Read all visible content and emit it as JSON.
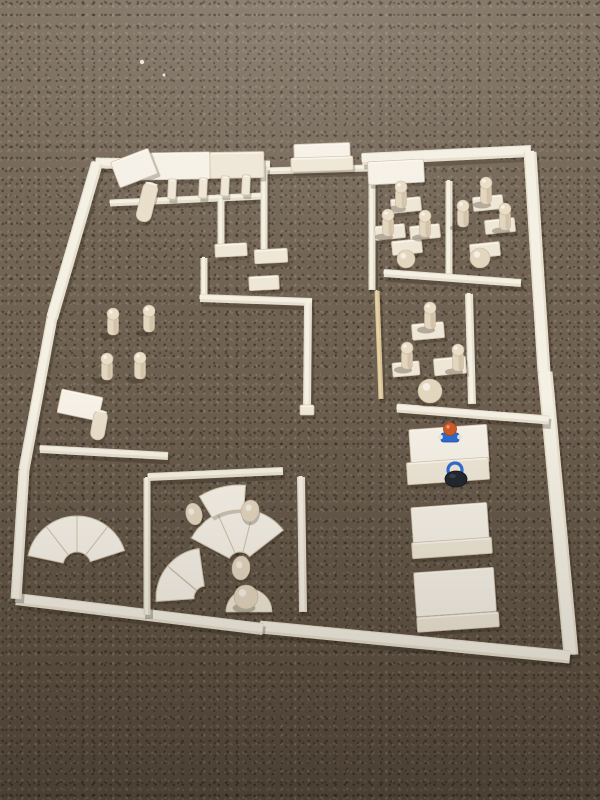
{
  "scene": {
    "description": "Photograph of a building floor plan constructed from light wooden unit blocks on brown carpet, with wooden peg dolls, desks, fan-shaped quarter-circle blocks, stacked board platforms and two small colored toy figures.",
    "colors": {
      "wall_base": "#e7dfcd",
      "wall_core": "#f5f0e4",
      "block_base": "#eee6d6",
      "block_bright": "#f6f1e7",
      "block_stroke": "#d0c3ab",
      "block_highlight": "#fbf7ef",
      "cylinder": "#e9deca",
      "tan_base": "#d9c396",
      "tan_core": "#e6d3a8",
      "peg_body": "#e3d6bf",
      "peg_shade": "#bdab8e",
      "peg_head": "#e9ddc7",
      "peg_stroke": "#c6b498",
      "shadow": "#2a2014",
      "figure_orange": "#cf5a2a",
      "figure_blue": "#2f6bd0",
      "figure_dark": "#23272f",
      "speck_white": "#f4f1ea"
    },
    "walls": [
      {
        "name": "top-wall-left",
        "x1": 96,
        "y1": 163,
        "x2": 270,
        "y2": 166,
        "w": 11
      },
      {
        "name": "top-door-rail",
        "x1": 264,
        "y1": 171,
        "x2": 368,
        "y2": 168,
        "w": 7
      },
      {
        "name": "top-wall-right",
        "x1": 362,
        "y1": 159,
        "x2": 531,
        "y2": 151,
        "w": 12
      },
      {
        "name": "right-wall-upper",
        "x1": 530,
        "y1": 152,
        "x2": 544,
        "y2": 372,
        "w": 13
      },
      {
        "name": "right-wall-lower",
        "x1": 545,
        "y1": 372,
        "x2": 571,
        "y2": 655,
        "w": 15
      },
      {
        "name": "bottom-wall-right",
        "x1": 260,
        "y1": 627,
        "x2": 570,
        "y2": 657,
        "w": 13
      },
      {
        "name": "bottom-wall-left",
        "x1": 16,
        "y1": 599,
        "x2": 263,
        "y2": 629,
        "w": 12
      },
      {
        "name": "left-wall-upper",
        "x1": 97,
        "y1": 163,
        "x2": 52,
        "y2": 318,
        "w": 12
      },
      {
        "name": "left-wall-middle",
        "x1": 52,
        "y1": 318,
        "x2": 24,
        "y2": 470,
        "w": 11
      },
      {
        "name": "left-wall-lower",
        "x1": 24,
        "y1": 470,
        "x2": 16,
        "y2": 599,
        "w": 11
      },
      {
        "name": "colonnade-rail",
        "x1": 110,
        "y1": 203,
        "x2": 262,
        "y2": 196,
        "w": 7
      },
      {
        "name": "maze-wall-vertical-1",
        "x1": 264,
        "y1": 166,
        "x2": 264,
        "y2": 257,
        "w": 7
      },
      {
        "name": "maze-wall-vertical-2",
        "x1": 221,
        "y1": 200,
        "x2": 221,
        "y2": 246,
        "w": 7
      },
      {
        "name": "maze-wall-vertical-3",
        "x1": 204,
        "y1": 258,
        "x2": 204,
        "y2": 297,
        "w": 7
      },
      {
        "name": "maze-wall-horizontal",
        "x1": 200,
        "y1": 298,
        "x2": 312,
        "y2": 302,
        "w": 8
      },
      {
        "name": "corridor-wall",
        "x1": 308,
        "y1": 303,
        "x2": 307,
        "y2": 410,
        "w": 8
      },
      {
        "name": "classroom1-left-wall",
        "x1": 372,
        "y1": 182,
        "x2": 372,
        "y2": 290,
        "w": 7
      },
      {
        "name": "classroom1-divider",
        "x1": 449,
        "y1": 181,
        "x2": 449,
        "y2": 274,
        "w": 7
      },
      {
        "name": "classroom1-bottom-wall",
        "x1": 384,
        "y1": 273,
        "x2": 521,
        "y2": 283,
        "w": 8
      },
      {
        "name": "classroom2-left-stick",
        "x1": 377,
        "y1": 291,
        "x2": 381,
        "y2": 399,
        "w": 5,
        "tone": "tan"
      },
      {
        "name": "classroom2-divider",
        "x1": 469,
        "y1": 294,
        "x2": 472,
        "y2": 404,
        "w": 8
      },
      {
        "name": "classroom2-bottom-wall",
        "x1": 397,
        "y1": 408,
        "x2": 549,
        "y2": 420,
        "w": 9
      },
      {
        "name": "left-room-wall",
        "x1": 40,
        "y1": 449,
        "x2": 168,
        "y2": 456,
        "w": 8
      },
      {
        "name": "playroom-top-wall",
        "x1": 148,
        "y1": 477,
        "x2": 283,
        "y2": 471,
        "w": 8
      },
      {
        "name": "playroom-left-wall",
        "x1": 147,
        "y1": 478,
        "x2": 147,
        "y2": 615,
        "w": 7
      },
      {
        "name": "playroom-right-wall",
        "x1": 301,
        "y1": 477,
        "x2": 303,
        "y2": 612,
        "w": 8
      }
    ],
    "blocks": [
      {
        "name": "roof-board-1",
        "cx": 172,
        "cy": 166,
        "w": 76,
        "h": 27,
        "rot": -1,
        "tone": "bright"
      },
      {
        "name": "roof-board-2",
        "cx": 237,
        "cy": 165,
        "w": 54,
        "h": 26,
        "rot": -1
      },
      {
        "name": "tower-block",
        "cx": 134,
        "cy": 168,
        "w": 40,
        "h": 27,
        "rot": -21,
        "tone": "bright"
      },
      {
        "name": "tower-cylinder",
        "cx": 147,
        "cy": 202,
        "w": 15,
        "h": 40,
        "rot": 14,
        "tone": "cyl",
        "rx": 7
      },
      {
        "name": "colonnade-pillar-1",
        "cx": 172,
        "cy": 189,
        "w": 8,
        "h": 20,
        "rot": 3
      },
      {
        "name": "colonnade-pillar-2",
        "cx": 203,
        "cy": 188,
        "w": 8,
        "h": 20,
        "rot": 3
      },
      {
        "name": "colonnade-pillar-3",
        "cx": 225,
        "cy": 186,
        "w": 8,
        "h": 20,
        "rot": 3
      },
      {
        "name": "colonnade-pillar-4",
        "cx": 246,
        "cy": 185,
        "w": 8,
        "h": 20,
        "rot": 3
      },
      {
        "name": "entrance-block-top",
        "cx": 322,
        "cy": 151,
        "w": 56,
        "h": 15,
        "rot": -2,
        "tone": "bright"
      },
      {
        "name": "entrance-block-base",
        "cx": 322,
        "cy": 164,
        "w": 62,
        "h": 14,
        "rot": -2
      },
      {
        "name": "classroom1-header-block",
        "cx": 396,
        "cy": 172,
        "w": 56,
        "h": 23,
        "rot": -3,
        "tone": "bright"
      },
      {
        "name": "maze-block-1",
        "cx": 231,
        "cy": 250,
        "w": 32,
        "h": 13,
        "rot": -3
      },
      {
        "name": "maze-block-2",
        "cx": 271,
        "cy": 256,
        "w": 33,
        "h": 14,
        "rot": -3
      },
      {
        "name": "maze-block-3",
        "cx": 264,
        "cy": 283,
        "w": 30,
        "h": 14,
        "rot": -3
      },
      {
        "name": "corridor-foot-block",
        "cx": 307,
        "cy": 410,
        "w": 14,
        "h": 10,
        "rot": 0
      },
      {
        "name": "classroom1-desk-1",
        "cx": 406,
        "cy": 205,
        "w": 30,
        "h": 14,
        "rot": -6
      },
      {
        "name": "classroom1-desk-2",
        "cx": 390,
        "cy": 232,
        "w": 30,
        "h": 14,
        "rot": -6
      },
      {
        "name": "classroom1-desk-3",
        "cx": 425,
        "cy": 232,
        "w": 30,
        "h": 14,
        "rot": -6
      },
      {
        "name": "classroom1-desk-4",
        "cx": 407,
        "cy": 247,
        "w": 30,
        "h": 14,
        "rot": -6
      },
      {
        "name": "classroom1-desk-5",
        "cx": 488,
        "cy": 203,
        "w": 30,
        "h": 14,
        "rot": -6
      },
      {
        "name": "classroom1-desk-6",
        "cx": 500,
        "cy": 226,
        "w": 30,
        "h": 14,
        "rot": -6
      },
      {
        "name": "classroom1-desk-7",
        "cx": 485,
        "cy": 250,
        "w": 30,
        "h": 14,
        "rot": -6
      },
      {
        "name": "classroom2-desk-1",
        "cx": 428,
        "cy": 331,
        "w": 32,
        "h": 16,
        "rot": -5
      },
      {
        "name": "classroom2-desk-2",
        "cx": 406,
        "cy": 369,
        "w": 27,
        "h": 14,
        "rot": -5
      },
      {
        "name": "classroom2-desk-3",
        "cx": 450,
        "cy": 366,
        "w": 32,
        "h": 17,
        "rot": -5
      },
      {
        "name": "table-block",
        "cx": 80,
        "cy": 405,
        "w": 42,
        "h": 24,
        "rot": 12,
        "tone": "bright"
      },
      {
        "name": "table-cylinder",
        "cx": 99,
        "cy": 425,
        "w": 14,
        "h": 30,
        "rot": 10,
        "tone": "cyl",
        "rx": 7
      },
      {
        "name": "platform1-board",
        "cx": 449,
        "cy": 446,
        "w": 78,
        "h": 38,
        "rot": -4,
        "tone": "bright"
      },
      {
        "name": "platform1-base",
        "cx": 448,
        "cy": 471,
        "w": 82,
        "h": 22,
        "rot": -4
      },
      {
        "name": "platform2-board",
        "cx": 450,
        "cy": 523,
        "w": 76,
        "h": 36,
        "rot": -4,
        "tone": "bright"
      },
      {
        "name": "platform2-base",
        "cx": 452,
        "cy": 548,
        "w": 80,
        "h": 16,
        "rot": -4
      },
      {
        "name": "platform3-board",
        "cx": 455,
        "cy": 592,
        "w": 80,
        "h": 44,
        "rot": -4,
        "tone": "bright"
      },
      {
        "name": "platform3-base",
        "cx": 458,
        "cy": 622,
        "w": 82,
        "h": 15,
        "rot": -4
      }
    ],
    "fans": [
      {
        "name": "fan-left",
        "cx": 77,
        "cy": 566,
        "r1": 14,
        "r2": 50,
        "segments": [
          [
            -168,
            -128
          ],
          [
            -128,
            -90
          ],
          [
            -90,
            -52
          ],
          [
            -52,
            -18
          ]
        ]
      },
      {
        "name": "fan-center-main",
        "cx": 240,
        "cy": 564,
        "r1": 12,
        "r2": 55,
        "segments": [
          [
            -152,
            -114
          ],
          [
            -114,
            -76
          ],
          [
            -76,
            -38
          ]
        ]
      },
      {
        "name": "fan-center-outer",
        "cx": 240,
        "cy": 564,
        "r1": 54,
        "r2": 79,
        "segments": [
          [
            -121,
            -86
          ]
        ]
      },
      {
        "name": "fan-lower",
        "cx": 206,
        "cy": 598,
        "r1": 12,
        "r2": 50,
        "segments": [
          [
            -184,
            -140
          ],
          [
            -140,
            -98
          ]
        ]
      }
    ],
    "dome": {
      "name": "playroom-dome",
      "cx": 249,
      "cy": 612,
      "r": 23
    },
    "eggs": [
      {
        "name": "playroom-egg-1",
        "cx": 194,
        "cy": 514,
        "rx": 8,
        "ry": 11,
        "rot": -15
      },
      {
        "name": "playroom-egg-2",
        "cx": 250,
        "cy": 511,
        "rx": 9,
        "ry": 11,
        "rot": 12
      },
      {
        "name": "playroom-egg-3",
        "cx": 241,
        "cy": 568,
        "rx": 9,
        "ry": 12,
        "rot": 5
      }
    ],
    "balls": [
      {
        "name": "classroom1-ball-1",
        "cx": 406,
        "cy": 259,
        "r": 9
      },
      {
        "name": "classroom1-ball-2",
        "cx": 480,
        "cy": 258,
        "r": 10
      },
      {
        "name": "classroom2-ball",
        "cx": 430,
        "cy": 391,
        "r": 12
      },
      {
        "name": "playroom-dome-ball",
        "cx": 246,
        "cy": 597,
        "r": 12
      }
    ],
    "pegs": [
      {
        "name": "classroom1-peg-1",
        "x": 401,
        "y": 187
      },
      {
        "name": "classroom1-peg-2",
        "x": 388,
        "y": 215
      },
      {
        "name": "classroom1-peg-3",
        "x": 425,
        "y": 216
      },
      {
        "name": "classroom1-peg-4",
        "x": 463,
        "y": 206
      },
      {
        "name": "classroom1-peg-5",
        "x": 486,
        "y": 183
      },
      {
        "name": "classroom1-peg-6",
        "x": 505,
        "y": 209
      },
      {
        "name": "hall-peg-1",
        "x": 113,
        "y": 314
      },
      {
        "name": "hall-peg-2",
        "x": 149,
        "y": 311
      },
      {
        "name": "hall-peg-3",
        "x": 107,
        "y": 359
      },
      {
        "name": "hall-peg-4",
        "x": 140,
        "y": 358
      },
      {
        "name": "classroom2-peg-1",
        "x": 430,
        "y": 308
      },
      {
        "name": "classroom2-peg-2",
        "x": 407,
        "y": 348
      },
      {
        "name": "classroom2-peg-3",
        "x": 458,
        "y": 350
      }
    ],
    "figures": [
      {
        "name": "figure-orange-head",
        "type": "orange",
        "x": 450,
        "y": 429
      },
      {
        "name": "figure-dark-blue",
        "type": "dark",
        "x": 456,
        "y": 476
      }
    ],
    "specks": [
      {
        "name": "carpet-lint-1",
        "cx": 142,
        "cy": 62,
        "r": 2.2
      },
      {
        "name": "carpet-lint-2",
        "cx": 164,
        "cy": 75,
        "r": 1.5
      }
    ]
  }
}
